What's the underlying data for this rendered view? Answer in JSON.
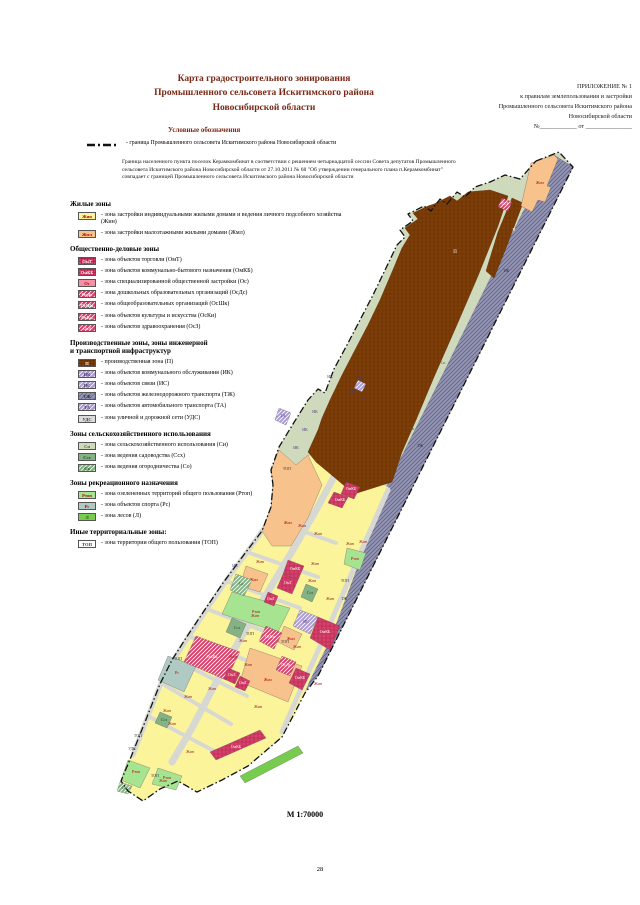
{
  "page": {
    "number": "28"
  },
  "header": {
    "title_lines": [
      "Карта градостроительного зонирования",
      "Промышленного сельсовета Искитимского района",
      "Новосибирской области"
    ],
    "appendix_lines": [
      "ПРИЛОЖЕНИЕ № 1",
      "к правилам землепользования и застройки",
      "Промышленного сельсовета Искитимского района",
      "Новосибирской области",
      "№____________ от _______________"
    ]
  },
  "legend": {
    "heading": "Условные обозначения",
    "boundary_item": "- граница Промышленного сельсовета Искитимского района Новосибирской области",
    "boundary_note": "Граница населенного пункта поселок Керамкомбинат в соответствии с решением четырнадцатой сессии Совета депутатов Промышленного сельсовета Искитимского района Новосибирской области от 27.10.2011 № 68 \"Об утверждении генерального плана п.Керамкомбинат\" совпадает с границей Промышленного сельсовета Искитимского района Новосибирской области",
    "sections": [
      {
        "title": "Жилые зоны",
        "items": [
          {
            "zone": "zhin",
            "code": "Жин",
            "desc": "- зона застройки индивидуальными жилыми домами и ведения личного подсобного хозяйства (Жин)"
          },
          {
            "zone": "zhml",
            "code": "Жмл",
            "desc": "- зона застройки малоэтажными жилыми домами (Жмл)"
          }
        ]
      },
      {
        "title": "Общественно-деловые зоны",
        "items": [
          {
            "zone": "omt",
            "code": "ОмТ",
            "desc": "- зона объектов торговли (ОмТ)"
          },
          {
            "zone": "omkb",
            "code": "ОмКБ",
            "desc": "- зона объектов коммунально-бытового назначения (ОмКБ)"
          },
          {
            "zone": "os",
            "code": "Ос",
            "desc": "- зона специализированной общественной застройки (Ос)"
          },
          {
            "zone": "osds",
            "code": "ОсДс",
            "desc": "- зона дошкольных образовательных организаций (ОсДс)"
          },
          {
            "zone": "osshk",
            "code": "ОсШк",
            "desc": "- зона общеобразовательных организаций (ОсШк)"
          },
          {
            "zone": "oski",
            "code": "ОсКи",
            "desc": "- зона объектов культуры и искусства (ОсКи)"
          },
          {
            "zone": "osz",
            "code": "ОсЗ",
            "desc": "- зона объектов здравоохранения (ОсЗ)"
          }
        ]
      },
      {
        "title": "Производственные зоны, зоны инженерной\nи транспортной инфраструктур",
        "items": [
          {
            "zone": "p",
            "code": "П",
            "desc": "- производственная зона (П)"
          },
          {
            "zone": "ik",
            "code": "ИК",
            "desc": "- зона объектов коммунального обслуживания (ИК)"
          },
          {
            "zone": "is",
            "code": "ИС",
            "desc": "- зона объектов связи (ИС)"
          },
          {
            "zone": "tzh",
            "code": "ТЖ",
            "desc": "- зона объектов железнодорожного транспорта (ТЖ)"
          },
          {
            "zone": "ta",
            "code": "ТА",
            "desc": "- зона объектов автомобильного транспорта (ТА)"
          },
          {
            "zone": "uds",
            "code": "УДС",
            "desc": "- зона уличной и дорожной сети (УДС)"
          }
        ]
      },
      {
        "title": "Зоны сельскохозяйственного использования",
        "items": [
          {
            "zone": "si",
            "code": "Си",
            "desc": "- зона сельскохозяйственного использования (Си)"
          },
          {
            "zone": "ssh",
            "code": "Ссх",
            "desc": "- зона ведения садоводства (Ссх)"
          },
          {
            "zone": "so",
            "code": "Со",
            "desc": "- зона ведения огородничества (Со)"
          }
        ]
      },
      {
        "title": "Зоны рекреационного назначения",
        "items": [
          {
            "zone": "rtop",
            "code": "Ртоп",
            "desc": "- зона озелененных территорий общего пользования (Ртоп)"
          },
          {
            "zone": "rs",
            "code": "Рс",
            "desc": "- зона объектов спорта (Рс)"
          },
          {
            "zone": "l",
            "code": "Л",
            "desc": "- зона лесов (Л)"
          }
        ]
      },
      {
        "title": "Иные территориальные зоны:",
        "items": [
          {
            "zone": "top",
            "code": "ТОП",
            "desc": "- зона территории общего пользования (ТОП)"
          }
        ]
      }
    ]
  },
  "map": {
    "scale_label": "М 1:70000",
    "boundary_color": "#111111",
    "road_color": "#d8d8d2",
    "zone_styles": {
      "zhin": {
        "fill": "#fbf49b",
        "label": "#b00000"
      },
      "zhml": {
        "fill": "#f8c28c",
        "label": "#b00000"
      },
      "omt": {
        "fill": "#d6406b",
        "label": "#ffffff",
        "pattern": "cross",
        "line": "#b2254e"
      },
      "omkb": {
        "fill": "#d6406b",
        "label": "#ffffff",
        "pattern": "cross",
        "line": "#b2254e"
      },
      "os": {
        "fill": "#f591a5",
        "label": "#b00000"
      },
      "osds": {
        "fill": "#d6406b",
        "label": "#ffffff",
        "pattern": "diag",
        "line": "#ffffff"
      },
      "osshk": {
        "fill": "#d6406b",
        "label": "#ffffff",
        "pattern": "diag",
        "line": "#ffffff"
      },
      "oski": {
        "fill": "#d6406b",
        "label": "#ffffff",
        "pattern": "diag",
        "line": "#ffffff"
      },
      "osz": {
        "fill": "#d6406b",
        "label": "#ffffff",
        "pattern": "diag",
        "line": "#ffffff"
      },
      "p": {
        "fill": "#7d3e08",
        "label": "#ffffff",
        "pattern": "cross",
        "line": "#6a3204"
      },
      "ik": {
        "fill": "#ac9bd0",
        "label": "#4a3a7a",
        "pattern": "diag",
        "line": "#ffffff"
      },
      "is": {
        "fill": "#ac9bd0",
        "label": "#4a3a7a",
        "pattern": "diag",
        "line": "#ffffff"
      },
      "tzh": {
        "fill": "#9494b2",
        "label": "#26264a",
        "pattern": "diag",
        "line": "#62628c"
      },
      "ta": {
        "fill": "#ac9bd0",
        "label": "#4a3a7a",
        "pattern": "diag",
        "line": "#ffffff"
      },
      "uds": {
        "fill": "#dcdcdc",
        "label": "#3d3d3d"
      },
      "si": {
        "fill": "#cfdabc",
        "label": "#4f5f3c"
      },
      "ssh": {
        "fill": "#84b284",
        "label": "#1a4a1a"
      },
      "so": {
        "fill": "#84b284",
        "label": "#1a4a1a",
        "pattern": "diag",
        "line": "#ffffff"
      },
      "rtop": {
        "fill": "#a6e492",
        "label": "#b00000"
      },
      "rs": {
        "fill": "#afc9c3",
        "label": "#b00000"
      },
      "l": {
        "fill": "#77cc4e",
        "label": "#1a4a1a"
      },
      "top": {
        "fill": "#ffffff",
        "label": "#3d3d3d"
      }
    },
    "geometry": {
      "outline": "536,161 559,152 573,167 318,676 305,693 282,737 248,766 222,780 197,792 178,781 160,789 143,801 128,791 121,781 131,757 147,717 160,684 172,660 186,638 204,611 223,583 243,556 262,531 271,507 273,485 271,470 279,447 293,424 308,400 318,389 325,393 334,369 347,345 360,320 373,295 386,268 397,245 405,237 400,230 413,221 408,214 424,206 431,211 440,199 447,204 457,192 465,197 475,187 490,182 505,175 520,179",
      "tzh": "554,155 573,167 318,676 305,691 287,728 277,721 291,679 299,661 440,380 523,212 549,170",
      "village": "296,465 308,455 330,462 352,472 374,481 390,488 377,520 360,560 345,600 330,640 310,680 295,715 283,735 248,766 222,780 197,792 178,781 160,789 143,801 128,791 121,781 131,757 147,717 160,684 172,660 186,638 204,611 223,583 243,556 262,531 271,507 273,485 271,470 279,450",
      "production": [
        "434,204 450,196 457,201 468,192 490,190 508,196 498,226 478,276 456,327 434,377 416,420 402,452 392,482 354,494 334,477 316,462 308,452 318,430 322,418 330,400 342,375 356,348 368,325 380,300 392,272 402,248 410,235 405,228 418,219 413,213 428,206",
        "512,198 523,203 506,248 494,278 486,271 498,232"
      ],
      "roads": [
        {
          "pts": "291,487 270,520 247,552 226,581 207,609 189,636 174,659 161,683 148,716 133,755",
          "w": 5
        },
        {
          "pts": "335,475 315,512 294,548 272,585 251,620 231,655 212,690 192,728 172,762",
          "w": 7
        },
        {
          "pts": "388,490 366,540 348,582 330,624 312,664 296,700 282,732",
          "w": 5
        },
        {
          "pts": "269,519 336,543",
          "w": 4
        },
        {
          "pts": "247,552 318,577",
          "w": 4
        },
        {
          "pts": "226,581 300,608",
          "w": 4
        },
        {
          "pts": "207,609 282,638",
          "w": 4
        },
        {
          "pts": "189,636 264,668",
          "w": 4
        },
        {
          "pts": "174,659 247,696",
          "w": 4
        },
        {
          "pts": "161,683 231,724",
          "w": 4
        },
        {
          "pts": "148,716 216,752",
          "w": 4
        }
      ]
    },
    "parcels": [
      {
        "z": "zhml",
        "pts": "531,163 554,155 558,159 547,186 551,187 545,202 538,200 532,212 521,206",
        "l": "Жмл",
        "lx": 540,
        "ly": 184
      },
      {
        "z": "zhml",
        "pts": "262,531 271,507 273,485 271,470 279,450 296,465 308,455 322,485 308,518 291,546 272,546",
        "l": "Жмл",
        "lx": 288,
        "ly": 524
      },
      {
        "z": "zhml",
        "pts": "246,566 268,574 260,592 240,586",
        "l": "Жмл",
        "lx": 254,
        "ly": 581
      },
      {
        "z": "zhml",
        "pts": "284,626 302,634 294,650 278,642",
        "l": "Жмл",
        "lx": 291,
        "ly": 640
      },
      {
        "z": "zhml",
        "pts": "250,648 302,666 288,702 240,682",
        "l": "Жмл",
        "lx": 268,
        "ly": 681
      },
      {
        "z": "rtop",
        "pts": "232,592 290,608 278,632 222,614",
        "l": "Ртоп",
        "lx": 256,
        "ly": 613
      },
      {
        "z": "rtop",
        "pts": "347,548 366,553 360,570 344,564",
        "l": "Ртоп",
        "lx": 355,
        "ly": 560
      },
      {
        "z": "rtop",
        "pts": "128,760 150,768 140,788 121,780",
        "l": "Ртоп",
        "lx": 136,
        "ly": 773
      },
      {
        "z": "rtop",
        "pts": "158,768 182,776 176,790 152,784",
        "l": "Ртоп",
        "lx": 167,
        "ly": 779
      },
      {
        "z": "l",
        "pts": "240,776 298,746 303,753 245,783"
      },
      {
        "z": "rs",
        "pts": "168,656 196,666 184,692 158,680",
        "l": "Рс",
        "lx": 177,
        "ly": 674
      },
      {
        "z": "omkb",
        "pts": "288,560 304,566 298,580 283,574",
        "l": "ОмКБ",
        "lx": 295,
        "ly": 570
      },
      {
        "z": "omt",
        "pts": "283,574 298,580 292,594 277,588",
        "l": "ОмТ",
        "lx": 288,
        "ly": 584
      },
      {
        "z": "omt",
        "pts": "268,592 278,596 274,606 264,602",
        "l": "ОмТ",
        "lx": 271,
        "ly": 600
      },
      {
        "z": "omkb",
        "pts": "318,617 340,626 330,650 310,638",
        "l": "ОмКБ",
        "lx": 325,
        "ly": 633
      },
      {
        "z": "oski",
        "pts": "266,626 282,633 274,649 259,641",
        "l": "ОсКи",
        "lx": 270,
        "ly": 638
      },
      {
        "z": "osshk",
        "pts": "196,636 240,652 226,680 184,662",
        "l": "ОсШк",
        "lx": 212,
        "ly": 658
      },
      {
        "z": "osds",
        "pts": "282,656 296,662 290,676 276,670",
        "l": "ОсДс",
        "lx": 286,
        "ly": 666
      },
      {
        "z": "omkb",
        "pts": "296,668 310,674 302,690 289,683",
        "l": "ОмКБ",
        "lx": 300,
        "ly": 679
      },
      {
        "z": "omt",
        "pts": "228,668 240,673 235,684 224,679",
        "l": "ОмТ",
        "lx": 232,
        "ly": 676
      },
      {
        "z": "omt",
        "pts": "240,676 250,681 245,691 235,687",
        "l": "ОмТ",
        "lx": 243,
        "ly": 684
      },
      {
        "z": "omkb",
        "pts": "210,752 260,730 266,738 216,760",
        "l": "ОмКБ",
        "lx": 236,
        "ly": 748
      },
      {
        "z": "omkb",
        "pts": "346,482 360,487 354,499 341,494",
        "l": "ОмКБ",
        "lx": 351,
        "ly": 490
      },
      {
        "z": "omkb",
        "pts": "334,492 348,497 342,508 328,503",
        "l": "ОмКБ",
        "lx": 340,
        "ly": 501
      },
      {
        "z": "osz",
        "pts": "502,198 512,202 508,211 498,207",
        "l": "ОсЗ",
        "lx": 505,
        "ly": 205
      },
      {
        "z": "so",
        "pts": "236,574 252,580 244,596 230,590",
        "l": "Со",
        "lx": 241,
        "ly": 585
      },
      {
        "z": "ssh",
        "pts": "306,584 318,589 312,602 301,597",
        "l": "Ссх",
        "lx": 310,
        "ly": 594
      },
      {
        "z": "ssh",
        "pts": "232,618 246,624 240,638 226,632",
        "l": "Ссх",
        "lx": 237,
        "ly": 629
      },
      {
        "z": "ssh",
        "pts": "160,712 172,717 167,728 155,723",
        "l": "Ссх",
        "lx": 164,
        "ly": 721
      },
      {
        "z": "so",
        "pts": "120,782 132,786 128,794 117,791",
        "l": "Со",
        "lx": 124,
        "ly": 789
      },
      {
        "z": "is",
        "pts": "300,610 318,617 310,634 293,626",
        "l": "ИС",
        "lx": 306,
        "ly": 623
      },
      {
        "z": "ik",
        "pts": "358,380 366,384 362,392 354,388",
        "l": "ИК",
        "lx": 360,
        "ly": 379
      },
      {
        "z": "ta",
        "pts": "279,408 291,413 286,425 275,420",
        "l": "ТА",
        "lx": 283,
        "ly": 417
      }
    ],
    "labels": [
      {
        "t": "П",
        "x": 455,
        "y": 253,
        "c": "#ffffff",
        "s": 5
      },
      {
        "t": "П",
        "x": 514,
        "y": 231,
        "c": "#ffffff"
      },
      {
        "t": "ТЖ",
        "x": 506,
        "y": 272,
        "c": "#26264a"
      },
      {
        "t": "ТЖ",
        "x": 420,
        "y": 447,
        "c": "#26264a"
      },
      {
        "t": "ТЖ",
        "x": 344,
        "y": 600,
        "c": "#26264a"
      },
      {
        "t": "Си",
        "x": 443,
        "y": 364,
        "c": "#4f5f3c"
      },
      {
        "t": "Си",
        "x": 498,
        "y": 252,
        "c": "#4f5f3c"
      },
      {
        "t": "Си",
        "x": 412,
        "y": 430,
        "c": "#4f5f3c"
      },
      {
        "t": "ИК",
        "x": 353,
        "y": 393,
        "c": "#4a3a7a"
      },
      {
        "t": "ИК",
        "x": 364,
        "y": 400,
        "c": "#4a3a7a"
      },
      {
        "t": "ИК",
        "x": 330,
        "y": 378,
        "c": "#4a3a7a"
      },
      {
        "t": "ИК",
        "x": 315,
        "y": 413,
        "c": "#4a3a7a"
      },
      {
        "t": "ИК",
        "x": 305,
        "y": 431,
        "c": "#4a3a7a"
      },
      {
        "t": "ИК",
        "x": 296,
        "y": 449,
        "c": "#4a3a7a"
      },
      {
        "t": "ИК",
        "x": 235,
        "y": 567,
        "c": "#4a3a7a"
      },
      {
        "t": "ТОП",
        "x": 287,
        "y": 470,
        "c": "#3d3d3d"
      },
      {
        "t": "ТОП",
        "x": 345,
        "y": 582,
        "c": "#3d3d3d"
      },
      {
        "t": "ТОП",
        "x": 250,
        "y": 635,
        "c": "#3d3d3d"
      },
      {
        "t": "ТОП",
        "x": 285,
        "y": 643,
        "c": "#3d3d3d"
      },
      {
        "t": "ТОП",
        "x": 178,
        "y": 660,
        "c": "#3d3d3d"
      },
      {
        "t": "ТОП",
        "x": 138,
        "y": 737,
        "c": "#3d3d3d"
      },
      {
        "t": "ТОП",
        "x": 155,
        "y": 777,
        "c": "#3d3d3d"
      },
      {
        "t": "УДС",
        "x": 132,
        "y": 750,
        "c": "#3d3d3d"
      },
      {
        "t": "Жин",
        "x": 302,
        "y": 527
      },
      {
        "t": "Жин",
        "x": 318,
        "y": 535
      },
      {
        "t": "Жин",
        "x": 350,
        "y": 545
      },
      {
        "t": "Жин",
        "x": 363,
        "y": 543
      },
      {
        "t": "Жин",
        "x": 260,
        "y": 563
      },
      {
        "t": "Жин",
        "x": 315,
        "y": 565
      },
      {
        "t": "Жин",
        "x": 312,
        "y": 582
      },
      {
        "t": "Жин",
        "x": 330,
        "y": 600
      },
      {
        "t": "Жин",
        "x": 255,
        "y": 617
      },
      {
        "t": "Жин",
        "x": 243,
        "y": 642
      },
      {
        "t": "Жин",
        "x": 233,
        "y": 658
      },
      {
        "t": "Жин",
        "x": 248,
        "y": 666
      },
      {
        "t": "Жин",
        "x": 297,
        "y": 648
      },
      {
        "t": "Жин",
        "x": 318,
        "y": 685
      },
      {
        "t": "Жин",
        "x": 212,
        "y": 690
      },
      {
        "t": "Жин",
        "x": 188,
        "y": 698
      },
      {
        "t": "Жин",
        "x": 167,
        "y": 712
      },
      {
        "t": "Жин",
        "x": 172,
        "y": 725
      },
      {
        "t": "Жин",
        "x": 258,
        "y": 708
      },
      {
        "t": "Жин",
        "x": 190,
        "y": 753
      },
      {
        "t": "Жин",
        "x": 163,
        "y": 782
      }
    ]
  }
}
